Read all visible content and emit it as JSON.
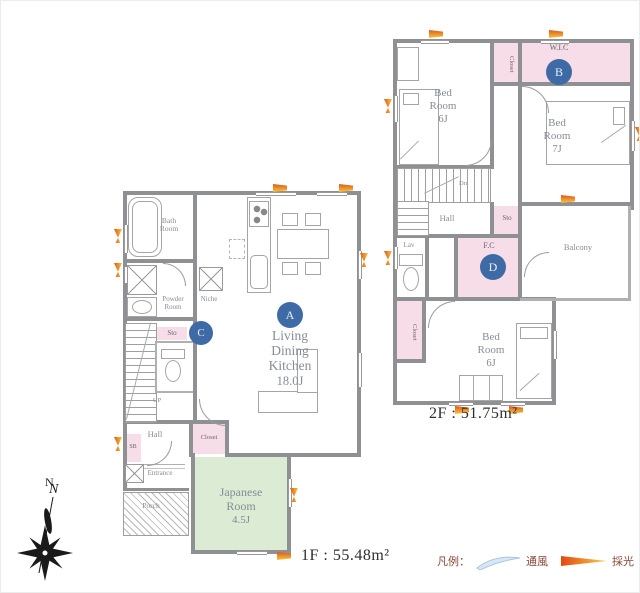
{
  "colors": {
    "wall": "#8e9094",
    "closet_pink": "#f7dde8",
    "tatami_green": "#dcebd3",
    "marker_blue": "#3e6ba5",
    "daylight_orange": "#e2571d",
    "daylight_yellow": "#f6c63c",
    "wind_blue": "#d6e7f5"
  },
  "floor1": {
    "area_label": "1F : 55.48m²",
    "ldk": {
      "l1": "Living",
      "l2": "Dining",
      "l3": "Kitchen",
      "size": "18.0J",
      "marker": "A"
    },
    "japanese": {
      "l1": "Japanese",
      "l2": "Room",
      "size": "4.5J"
    },
    "bath": {
      "l1": "Bath",
      "l2": "Room"
    },
    "powder": {
      "l1": "Powder",
      "l2": "Room"
    },
    "niche": "Niche",
    "sto": "Sto",
    "marker_c": "C",
    "up": "UP",
    "hall": "Hall",
    "closet": "Closet",
    "entrance": "Entrance",
    "sb": "SB",
    "porch": "Porch"
  },
  "floor2": {
    "area_label": "2F : 51.75m²",
    "bedroom_nw": {
      "l1": "Bed",
      "l2": "Room",
      "size": "6J"
    },
    "closet_top": "Closet",
    "wic": {
      "label": "W.I.C",
      "marker": "B"
    },
    "bedroom_e": {
      "l1": "Bed",
      "l2": "Room",
      "size": "7J"
    },
    "hall": "Hall",
    "dn": "Dn",
    "sto": "Sto",
    "lav": "Lav",
    "fc": {
      "label": "F.C",
      "marker": "D"
    },
    "balcony": "Balcony",
    "closet_s": "Closet",
    "bedroom_s": {
      "l1": "Bed",
      "l2": "Room",
      "size": "6J"
    }
  },
  "compass": {
    "north": "N"
  },
  "legend": {
    "title": "凡例：",
    "wind": "通風",
    "light": "採光"
  }
}
